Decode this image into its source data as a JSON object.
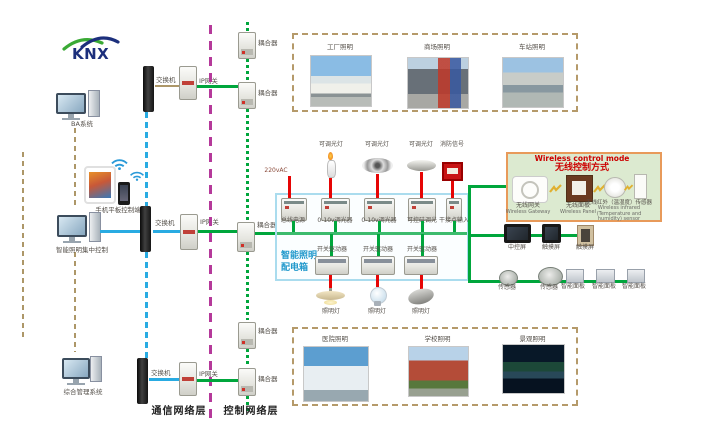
{
  "logo": {
    "text": "KNX"
  },
  "left_terminals": {
    "ba": "BA系统",
    "mobile": "手机平板控制端",
    "lighting_control": "智能照明集中控制",
    "management": "综合管理系统"
  },
  "layers": {
    "communication": "通信网络层",
    "control": "控制网络层"
  },
  "switches": [
    "交换机",
    "交换机",
    "交换机"
  ],
  "gateways": [
    "IP网关",
    "IP网关",
    "IP网关"
  ],
  "couplers": [
    "耦合器",
    "耦合器",
    "耦合器",
    "耦合器",
    "耦合器"
  ],
  "photos_top": [
    {
      "label": "工厂照明"
    },
    {
      "label": "商场照明"
    },
    {
      "label": "车站照明"
    }
  ],
  "photos_bottom": [
    {
      "label": "医院照明"
    },
    {
      "label": "学校照明"
    },
    {
      "label": "景观照明"
    }
  ],
  "dist": {
    "title1": "智能照明",
    "title2": "配电箱",
    "ac": "220vAC",
    "loads_top": [
      "可调光灯",
      "可调光灯",
      "可调光灯",
      "消防信号"
    ],
    "modules_top": [
      "总线电源",
      "0-10v调光器",
      "0-10v调光器",
      "可控硅调光",
      "干接点输入"
    ],
    "drivers": [
      "开关驱动器",
      "开关驱动器",
      "开关驱动器"
    ],
    "lamps": [
      "照明灯",
      "照明灯",
      "照明灯"
    ]
  },
  "wireless": {
    "title_en": "Wireless control mode",
    "title_zh": "无线控制方式",
    "devices": [
      {
        "zh": "无线网关",
        "en": "Wireless Gateway"
      },
      {
        "zh": "无线面板",
        "en": "Wireless Panel"
      },
      {
        "zh": "无线红外（温湿度）传感器",
        "en": "Wireless infrared (Temperature and humidity) sensor"
      }
    ]
  },
  "screens": [
    "中控屏",
    "触摸屏",
    "触摸屏"
  ],
  "sensors": [
    "传感器",
    "传感器"
  ],
  "panels": [
    "智能面板",
    "智能面板",
    "智能面板"
  ],
  "colors": {
    "bus_green": "#00a63c",
    "ethernet_blue": "#29abe2",
    "load_red": "#e60505",
    "divider_magenta": "#b5399a",
    "group_tan": "#ad9768",
    "wireless_border": "#e89a5a",
    "wireless_bg": "#dcead0",
    "dist_border": "#aadcee"
  }
}
